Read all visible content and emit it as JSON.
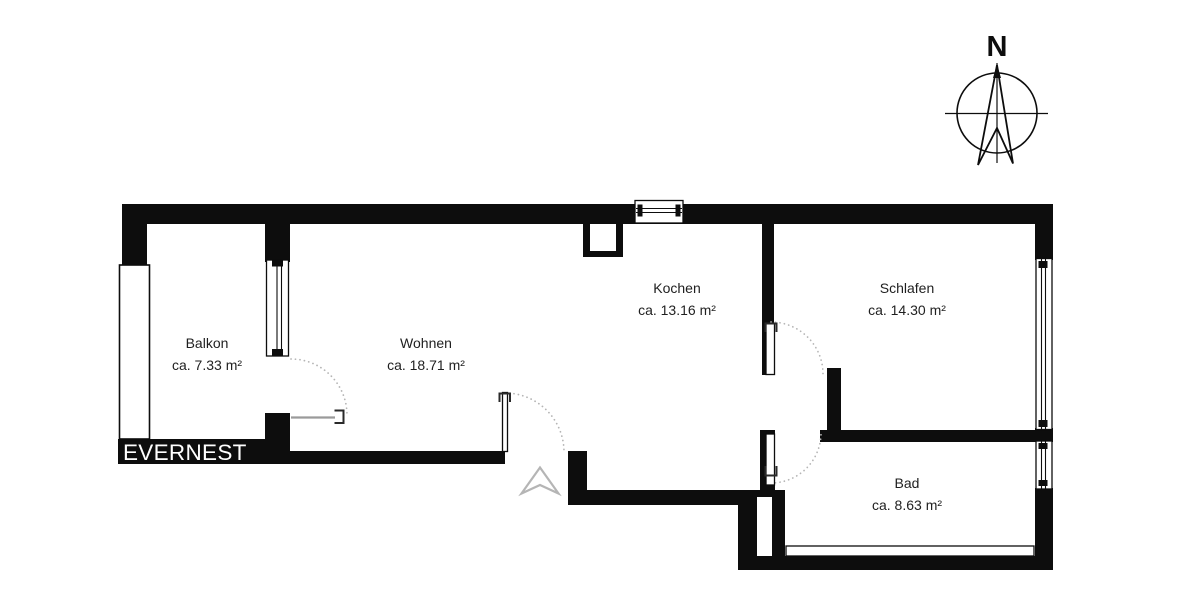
{
  "brand": {
    "name": "EVERNEST"
  },
  "compass": {
    "north_label": "N"
  },
  "rooms": [
    {
      "id": "balkon",
      "label": "Balkon",
      "area": "ca. 7.33 m²"
    },
    {
      "id": "wohnen",
      "label": "Wohnen",
      "area": "ca. 18.71 m²"
    },
    {
      "id": "kochen",
      "label": "Kochen",
      "area": "ca. 13.16 m²"
    },
    {
      "id": "schlafen",
      "label": "Schlafen",
      "area": "ca. 14.30 m²"
    },
    {
      "id": "bad",
      "label": "Bad",
      "area": "ca. 8.63 m²"
    }
  ],
  "colors": {
    "wall": "#0d0d0d",
    "background": "#ffffff",
    "room_text": "#1f1f1f",
    "brand_text": "#ffffff",
    "door_arc": "#b5b5b5",
    "door_leaf_gray": "#9a9a9a",
    "entrance_arrow": "#b5b5b5"
  }
}
